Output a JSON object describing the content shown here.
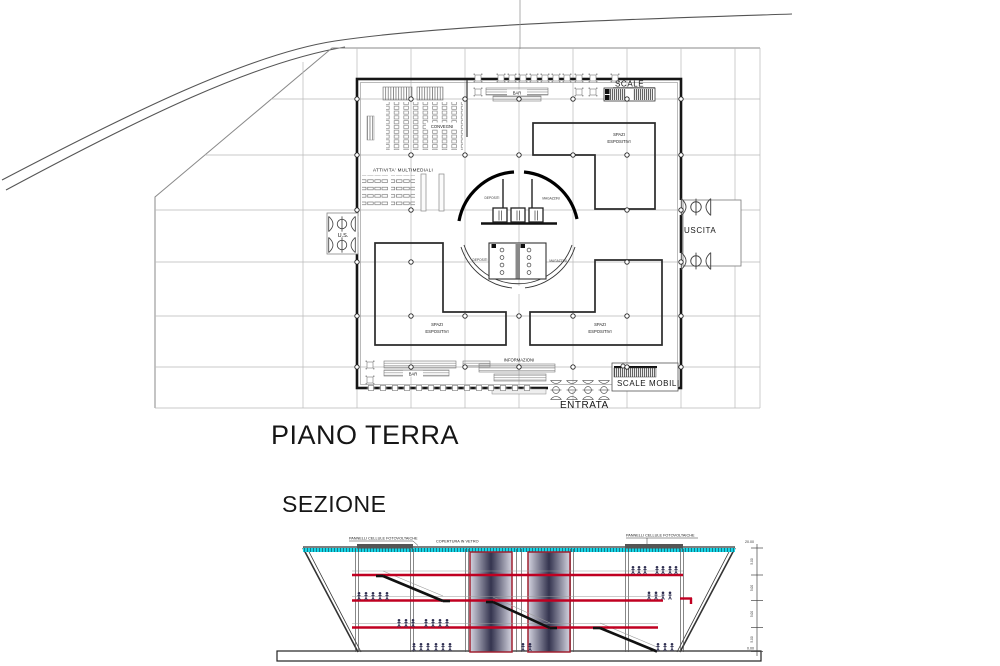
{
  "plan": {
    "title": "PIANO TERRA",
    "labels": {
      "scale": "SCALE",
      "bar": "BAR",
      "convegni": "CONVEGNI",
      "attivita": "ATTIVITA'  MULTIMEDIALI",
      "spazi_1": "SPAZI",
      "spazi_2": "ESPOSITIVI",
      "depositi": "DEPOSITI",
      "magazzini": "MAGAZZINI",
      "us": "U.S.",
      "uscita": "USCITA",
      "informazioni": "INFORMAZIONI",
      "scale_mobili": "SCALE MOBILI",
      "entrata": "ENTRATA"
    }
  },
  "section": {
    "title": "SEZIONE",
    "labels": {
      "pv": "PANNELLI CELLULE FOTOVOLTAICHE",
      "glass": "COPERTURA IN VETRO"
    },
    "elevations": {
      "top": "20.00",
      "bottom": "0.00",
      "dims": [
        "5.00",
        "5.00",
        "5.00",
        "5.00"
      ]
    }
  },
  "colors": {
    "glass_cyan": "#19d7e7",
    "slab_red": "#c00021",
    "pv_panel_dark": "#555555",
    "people_navy": "#2e2e50",
    "line_dark": "#1a1a1a",
    "grid_gray": "#b9b9b9"
  }
}
